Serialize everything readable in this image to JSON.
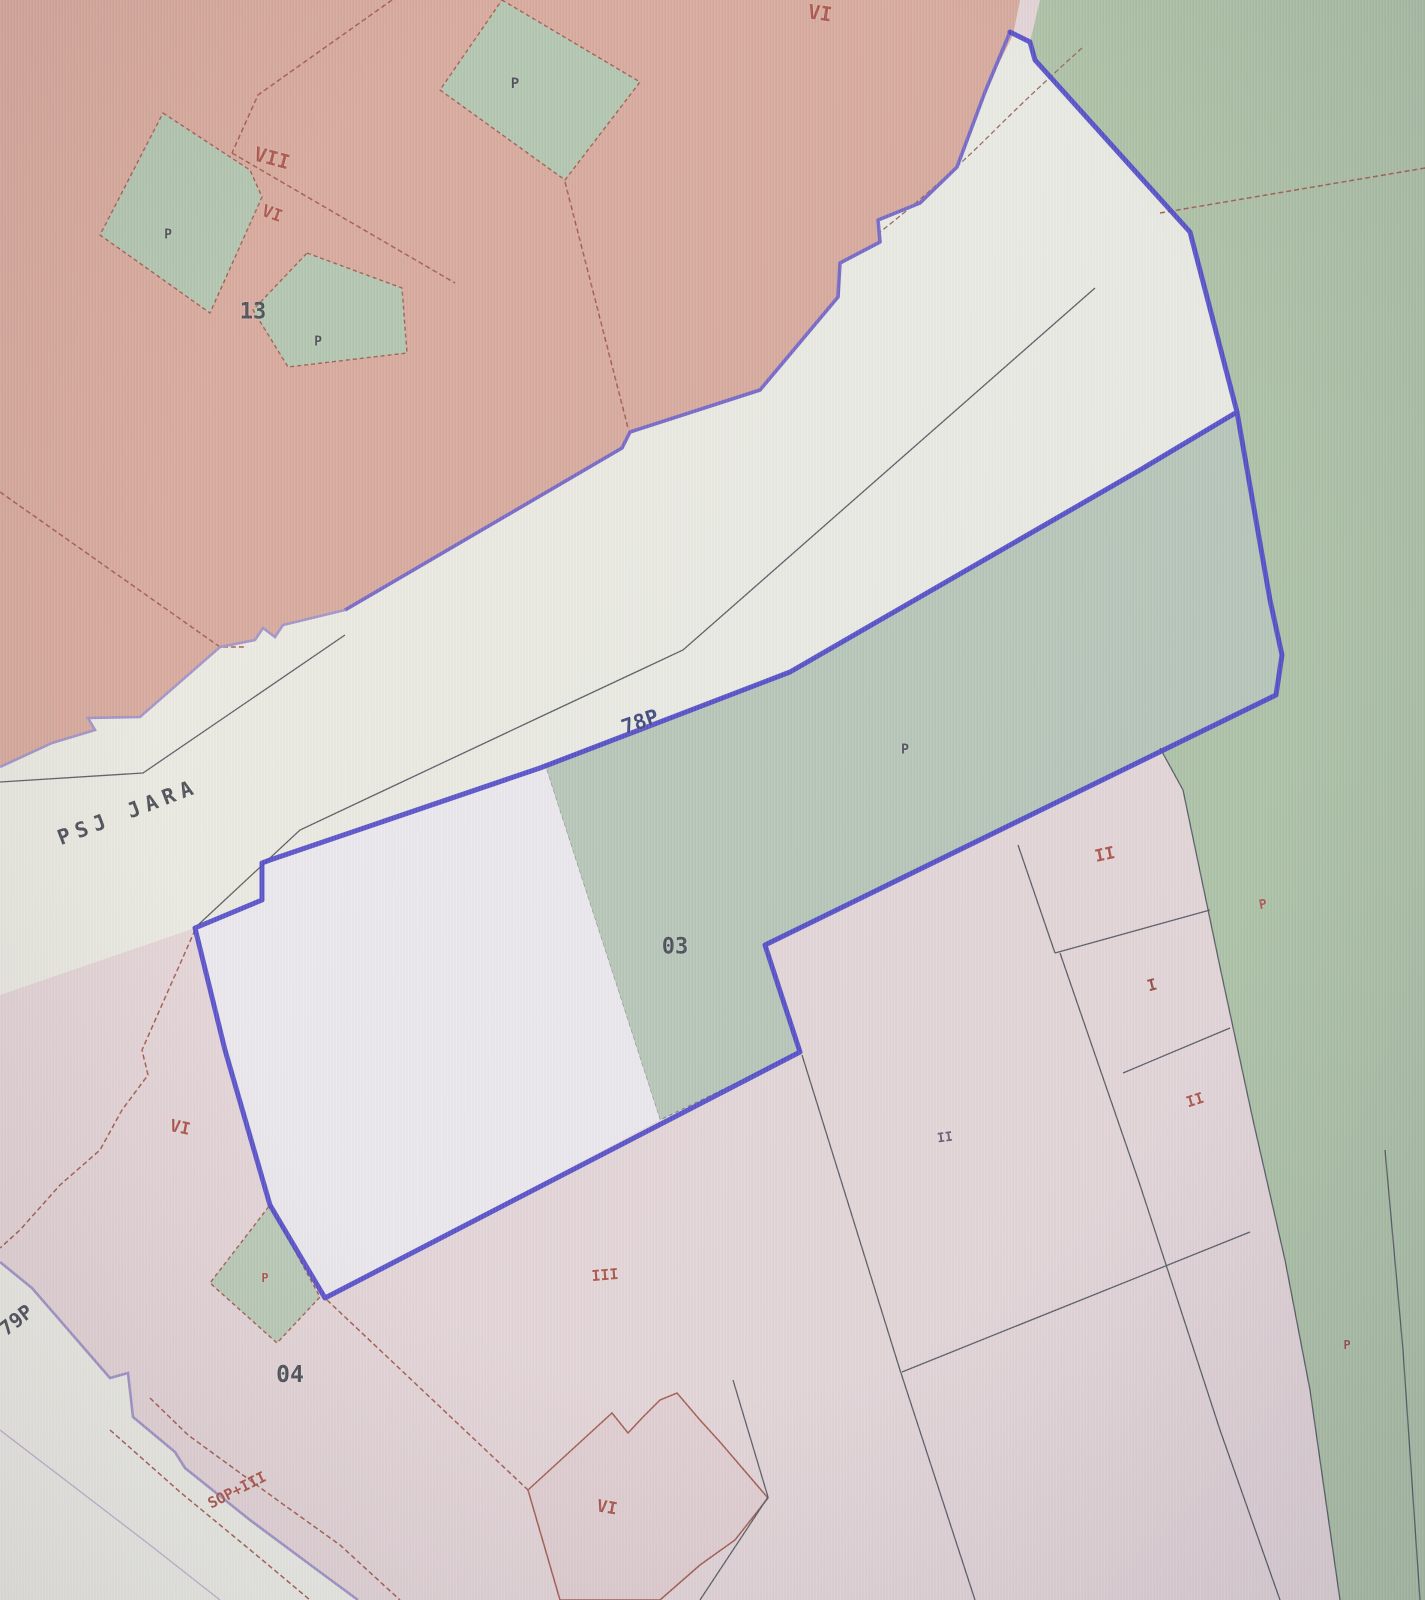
{
  "map": {
    "type": "cadastral-zoning-map",
    "street_name_label": "PSJ JARA",
    "road_code_labels": [
      "78P",
      "79P"
    ],
    "block_numbers": [
      "13",
      "03",
      "04"
    ],
    "zoning_codes": [
      "VI",
      "VII",
      "I",
      "II",
      "III",
      "P",
      "SOP+III"
    ],
    "palette": {
      "boundary_blue": "#3d36c4",
      "boundary_purple": "#6a5cc4",
      "street_edge_purple": "#9a8cc4",
      "salmon": "#d5a496",
      "green_east": "#a8bfa0",
      "green_parcel": "#b2c3b4",
      "green_diamond": "#abc3ab",
      "street_white": "#e9ebe2",
      "lavender_parcel": "#eae9ee",
      "base_pink": "#e3d4d6",
      "parcel_line_red": "#9c4f43",
      "line_dark": "#4a5058",
      "label_red": "#a4473c",
      "label_dark": "#3c4149",
      "label_blue": "#333a74",
      "label_purple": "#5c4f63",
      "label_darkred": "#8a4238"
    }
  },
  "labels": [
    {
      "text": "VI",
      "x": 820,
      "y": 13,
      "rot": 8,
      "size": 20,
      "color": "label_red"
    },
    {
      "text": "VII",
      "x": 272,
      "y": 158,
      "rot": 15,
      "size": 20,
      "color": "label_red"
    },
    {
      "text": "VI",
      "x": 272,
      "y": 214,
      "rot": 20,
      "size": 17,
      "color": "label_red"
    },
    {
      "text": "P",
      "x": 168,
      "y": 235,
      "rot": 0,
      "size": 13,
      "color": "label_dark"
    },
    {
      "text": "13",
      "x": 253,
      "y": 312,
      "rot": 0,
      "size": 22,
      "color": "label_dark"
    },
    {
      "text": "P",
      "x": 318,
      "y": 342,
      "rot": 0,
      "size": 13,
      "color": "label_dark"
    },
    {
      "text": "P",
      "x": 515,
      "y": 84,
      "rot": 0,
      "size": 14,
      "color": "label_dark"
    },
    {
      "text": "PSJ JARA",
      "x": 128,
      "y": 812,
      "rot": -21,
      "size": 21,
      "color": "label_dark",
      "spacing": 6
    },
    {
      "text": "78P",
      "x": 640,
      "y": 722,
      "rot": -19,
      "size": 21,
      "color": "label_blue"
    },
    {
      "text": "P",
      "x": 905,
      "y": 750,
      "rot": 0,
      "size": 13,
      "color": "label_dark"
    },
    {
      "text": "03",
      "x": 675,
      "y": 947,
      "rot": 0,
      "size": 22,
      "color": "label_dark"
    },
    {
      "text": "II",
      "x": 1105,
      "y": 855,
      "rot": -12,
      "size": 17,
      "color": "label_red"
    },
    {
      "text": "P",
      "x": 1263,
      "y": 905,
      "rot": -10,
      "size": 13,
      "color": "label_red"
    },
    {
      "text": "I",
      "x": 1152,
      "y": 985,
      "rot": -15,
      "size": 16,
      "color": "label_darkred"
    },
    {
      "text": "II",
      "x": 1195,
      "y": 1100,
      "rot": -18,
      "size": 15,
      "color": "label_red"
    },
    {
      "text": "VI",
      "x": 180,
      "y": 1128,
      "rot": 12,
      "size": 17,
      "color": "label_red"
    },
    {
      "text": "II",
      "x": 945,
      "y": 1138,
      "rot": -8,
      "size": 13,
      "color": "label_purple"
    },
    {
      "text": "P",
      "x": 265,
      "y": 1278,
      "rot": 0,
      "size": 12,
      "color": "label_red"
    },
    {
      "text": "III",
      "x": 605,
      "y": 1275,
      "rot": -5,
      "size": 15,
      "color": "label_red"
    },
    {
      "text": "04",
      "x": 290,
      "y": 1375,
      "rot": 0,
      "size": 23,
      "color": "label_dark"
    },
    {
      "text": "79P",
      "x": 16,
      "y": 1320,
      "rot": -38,
      "size": 20,
      "color": "label_dark"
    },
    {
      "text": "SOP+III",
      "x": 237,
      "y": 1490,
      "rot": -27,
      "size": 15,
      "color": "label_red"
    },
    {
      "text": "VI",
      "x": 607,
      "y": 1508,
      "rot": 10,
      "size": 17,
      "color": "label_red"
    },
    {
      "text": "P",
      "x": 1347,
      "y": 1345,
      "rot": 0,
      "size": 12,
      "color": "label_darkred"
    }
  ]
}
